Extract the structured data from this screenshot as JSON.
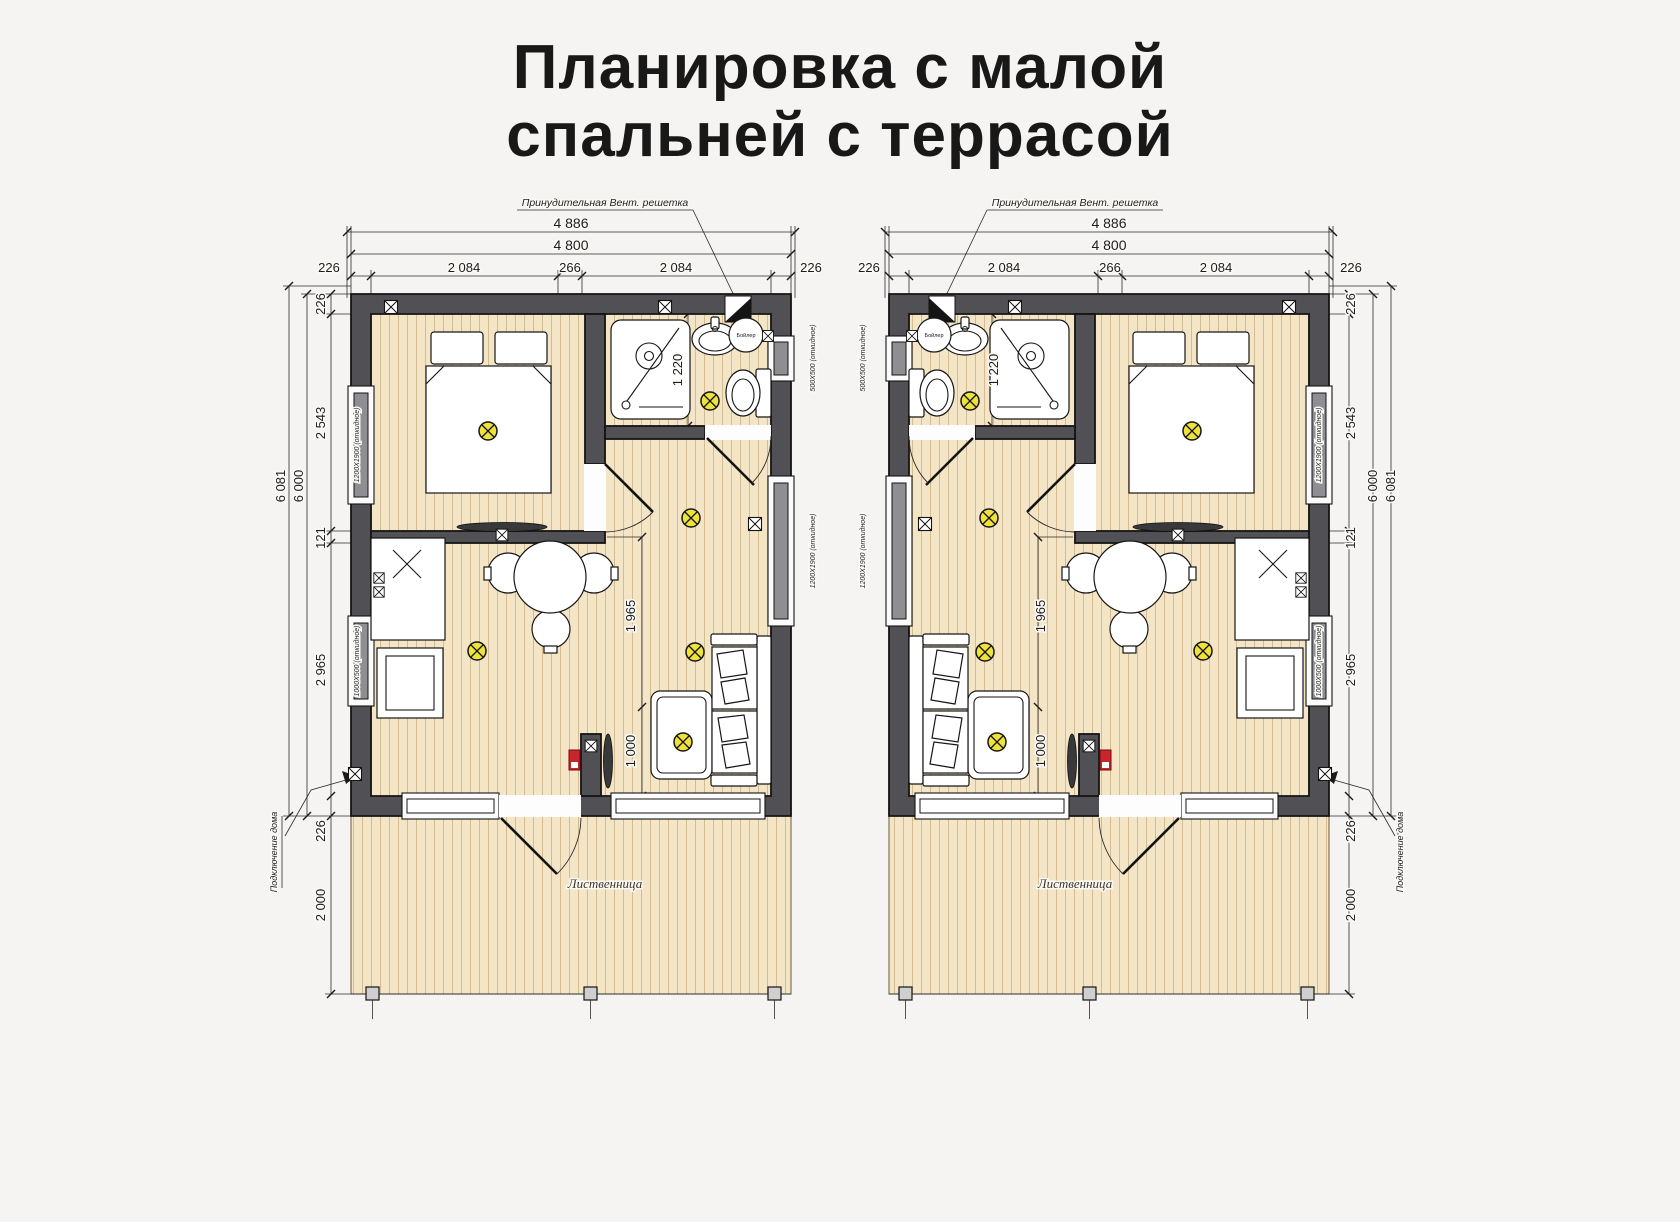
{
  "title": {
    "line1": "Планировка с малой",
    "line2": "спальней с террасой"
  },
  "dimensions": {
    "ext_width": "4 886",
    "width": "4 800",
    "wall": "226",
    "span_a": "2 084",
    "span_mid": "266",
    "span_b": "2 084",
    "ext_height": "6 081",
    "height": "6 000",
    "bedroom_depth": "2 543",
    "partition": "121",
    "living_depth": "2 965",
    "terrace_depth": "2 000",
    "bath_depth": "1 220",
    "hall_span": "1 965",
    "tv_span": "1 000"
  },
  "labels": {
    "vent": "Принудительная Вент. решетка",
    "house_connection": "Подключение дома",
    "boiler": "Бойлер",
    "terrace_wood": "Лиственница"
  },
  "windows": {
    "bedroom": "1200X1900 (откидное)",
    "kitchen": "1000X500 (откидное)",
    "bathroom": "500X500 (откидное)",
    "living": "1200X1900 (откидное)"
  },
  "colors": {
    "background": "#f5f4f2",
    "wall": "#515155",
    "floor": "#f4e5c6",
    "plank_line": "#d3bc92",
    "light_symbol": "#efe23b",
    "electric_panel": "#c9262c",
    "text": "#1d1d1d"
  }
}
